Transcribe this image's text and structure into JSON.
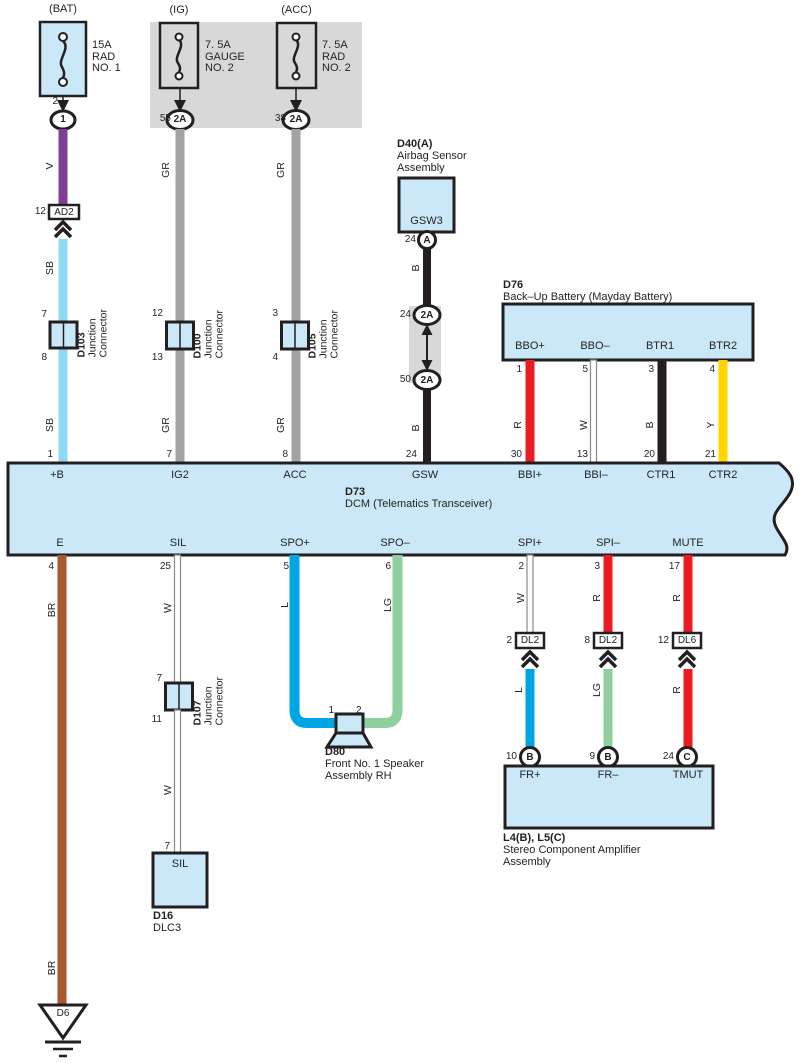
{
  "colors": {
    "component_fill": "#cbe8f8",
    "shade_gray": "#d8d8d8",
    "outline": "#231f20",
    "wire_v": "#7e3f97",
    "wire_sb": "#8ed8f2",
    "wire_gr": "#a3a3a3",
    "wire_b": "#231f20",
    "wire_r": "#ec1c24",
    "wire_y": "#ffd400",
    "wire_br": "#a8572e",
    "wire_l": "#00a6e4",
    "wire_lg": "#8ecf9d",
    "wire_w": "#ffffff"
  },
  "fuses": {
    "bat": {
      "tag": "(BAT)",
      "desc": "15A\nRAD\nNO. 1",
      "pin": "2",
      "oval": "1"
    },
    "ig": {
      "tag": "(IG)",
      "desc": "7. 5A\nGAUGE\nNO. 2",
      "pin": "55",
      "oval": "2A"
    },
    "acc": {
      "tag": "(ACC)",
      "desc": "7. 5A\nRAD\nNO. 2",
      "pin": "38",
      "oval": "2A"
    }
  },
  "bat_col": {
    "wire_v": "V",
    "conn_pin": "12",
    "conn": "AD2",
    "wire_sb_1": "SB",
    "wire_sb_2": "SB",
    "j_pin_top": "7",
    "j_id": "D103",
    "j_name": "Junction\nConnector",
    "j_pin_bot": "8",
    "band_pin": "1",
    "band_label": "+B"
  },
  "ig_col": {
    "wire_gr_1": "GR",
    "wire_gr_2": "GR",
    "j_pin_top": "12",
    "j_id": "D100",
    "j_name": "Junction\nConnector",
    "j_pin_bot": "13",
    "band_pin": "7",
    "band_label": "IG2"
  },
  "acc_col": {
    "wire_gr_1": "GR",
    "wire_gr_2": "GR",
    "j_pin_top": "3",
    "j_id": "D105",
    "j_name": "Junction\nConnector",
    "j_pin_bot": "4",
    "band_pin": "8",
    "band_label": "ACC"
  },
  "airbag": {
    "id": "D40(A)",
    "name": "Airbag Sensor\nAssembly",
    "conn_label": "GSW3",
    "pin_a": "24",
    "oval_a": "A",
    "wire_b_1": "B",
    "pin_2a_top": "24",
    "oval_2a_top": "2A",
    "pin_2a_bot": "50",
    "oval_2a_bot": "2A",
    "wire_b_2": "B",
    "band_pin": "24",
    "band_label": "GSW"
  },
  "backup_battery": {
    "id": "D76",
    "name": "Back–Up Battery (Mayday Battery)",
    "terminals": [
      {
        "label": "BBO+",
        "pin": "1",
        "wire": "R",
        "dcm_pin": "30",
        "dcm_label": "BBI+"
      },
      {
        "label": "BBO–",
        "pin": "5",
        "wire": "W",
        "dcm_pin": "13",
        "dcm_label": "BBI–"
      },
      {
        "label": "BTR1",
        "pin": "3",
        "wire": "B",
        "dcm_pin": "20",
        "dcm_label": "CTR1"
      },
      {
        "label": "BTR2",
        "pin": "4",
        "wire": "Y",
        "dcm_pin": "21",
        "dcm_label": "CTR2"
      }
    ]
  },
  "dcm": {
    "id": "D73",
    "name": "DCM (Telematics Transceiver)"
  },
  "ground_col": {
    "band_label": "E",
    "pin": "4",
    "wire_1": "BR",
    "wire_2": "BR",
    "gnd_id": "D6"
  },
  "sil_col": {
    "band_label": "SIL",
    "pin": "25",
    "wire_1": "W",
    "j_pin_top": "7",
    "j_id": "D107",
    "j_name": "Junction\nConnector",
    "j_pin_bot": "11",
    "wire_2": "W",
    "dlc_pin": "7",
    "dlc_conn": "SIL",
    "dlc_id": "D16",
    "dlc_name": "DLC3"
  },
  "speaker": {
    "p_label": "SPO+",
    "p_pin": "5",
    "p_wire": "L",
    "m_label": "SPO–",
    "m_pin": "6",
    "m_wire": "LG",
    "spk_pin_1": "1",
    "spk_pin_2": "2",
    "id": "D80",
    "name": "Front No. 1 Speaker\nAssembly RH"
  },
  "amp": {
    "id": "L4(B), L5(C)",
    "name": "Stereo Component Amplifier\nAssembly",
    "channels": [
      {
        "band_label": "SPI+",
        "band_pin": "2",
        "wire_top": "W",
        "conn_pin": "2",
        "conn": "DL2",
        "wire_bot": "L",
        "amp_pin": "10",
        "amp_oval": "B",
        "amp_label": "FR+"
      },
      {
        "band_label": "SPI–",
        "band_pin": "3",
        "wire_top": "R",
        "conn_pin": "8",
        "conn": "DL2",
        "wire_bot": "LG",
        "amp_pin": "9",
        "amp_oval": "B",
        "amp_label": "FR–"
      },
      {
        "band_label": "MUTE",
        "band_pin": "17",
        "wire_top": "R",
        "conn_pin": "12",
        "conn": "DL6",
        "wire_bot": "R",
        "amp_pin": "24",
        "amp_oval": "C",
        "amp_label": "TMUT"
      }
    ]
  }
}
